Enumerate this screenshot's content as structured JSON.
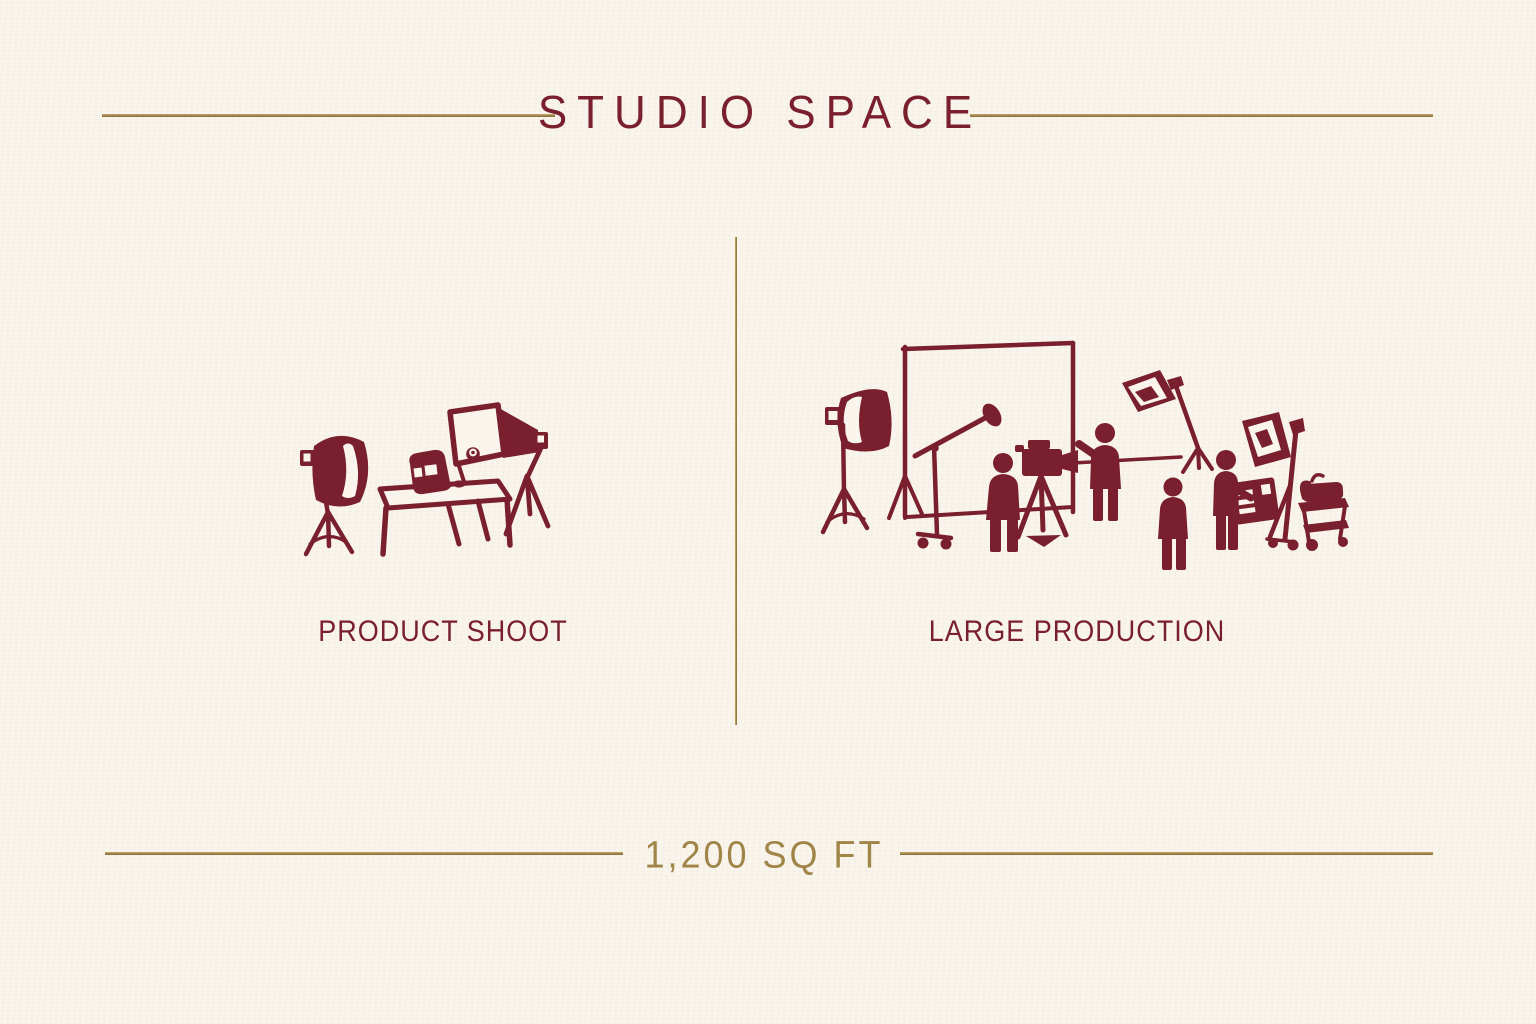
{
  "header": {
    "title": "STUDIO SPACE"
  },
  "panels": [
    {
      "label": "PRODUCT SHOOT",
      "illustration": "product-shoot-scene"
    },
    {
      "label": "LARGE PRODUCTION",
      "illustration": "large-production-scene"
    }
  ],
  "footer": {
    "area_label": "1,200 SQ FT"
  },
  "colors": {
    "background": "#f9f5ec",
    "illustration_maroon": "#7a1f2d",
    "accent_gold": "#a08448"
  }
}
